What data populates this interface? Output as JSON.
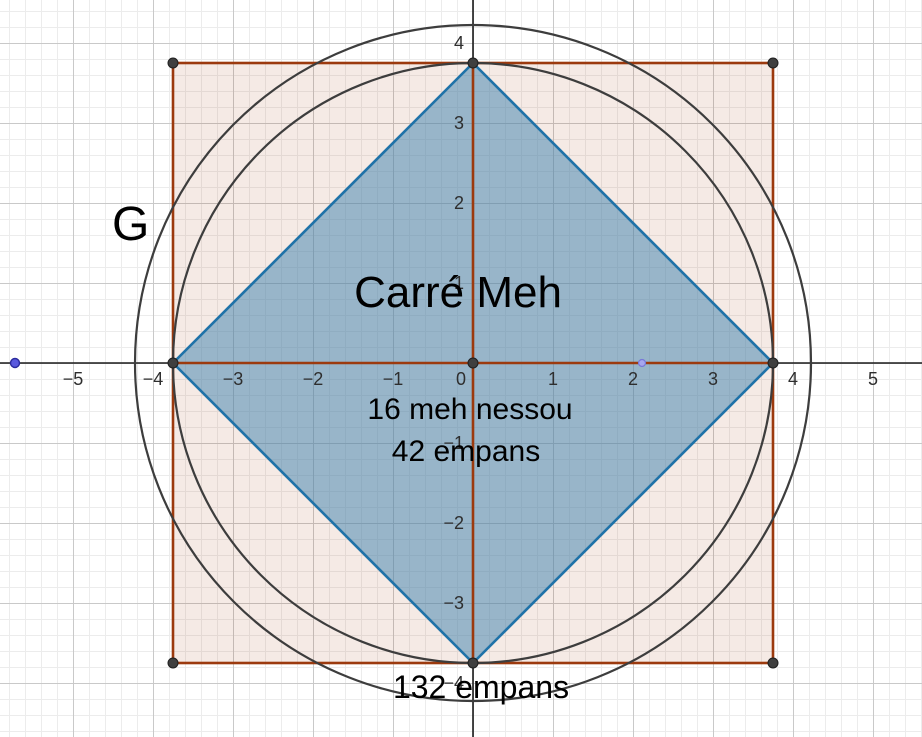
{
  "view": {
    "app": "geometry-graphics-view",
    "width": 922,
    "height": 737
  },
  "labels": {
    "g": "G",
    "title": "Carré Meh",
    "annotation_line1": "16 meh nessou",
    "annotation_line2": "42 empans",
    "annotation_bottom": "132 empans"
  },
  "axes": {
    "unit_px": 80,
    "origin_px": {
      "x": 473,
      "y": 363
    },
    "x_ticks": [
      "−5",
      "−4",
      "−3",
      "−2",
      "−1",
      "0",
      "1",
      "2",
      "3",
      "4",
      "5"
    ],
    "y_ticks": [
      "4",
      "3",
      "2",
      "1",
      "−1",
      "−2",
      "−3",
      "−4"
    ]
  },
  "shapes": {
    "square": {
      "x1": -3.75,
      "y1": -3.75,
      "x2": 3.75,
      "y2": 3.75
    },
    "diamond_vertices": [
      [
        -3.75,
        0
      ],
      [
        0,
        3.75
      ],
      [
        3.75,
        0
      ],
      [
        0,
        -3.75
      ]
    ],
    "inner_circle": {
      "cx": 0,
      "cy": 0,
      "r": 3.75
    },
    "outer_circle": {
      "cx": 0,
      "cy": 0,
      "r": 4.22
    },
    "points_gray": [
      [
        -3.75,
        3.75
      ],
      [
        0,
        3.75
      ],
      [
        3.75,
        3.75
      ],
      [
        -3.75,
        0
      ],
      [
        0,
        0
      ],
      [
        3.75,
        0
      ],
      [
        -3.75,
        -3.75
      ],
      [
        0,
        -3.75
      ],
      [
        3.75,
        -3.75
      ]
    ],
    "point_blue": [
      -5.72,
      0
    ],
    "point_lavender": [
      2.1,
      0
    ]
  },
  "colors": {
    "square_stroke": "#9c3a0e",
    "square_fill": "rgba(153,51,0,0.10)",
    "diamond_stroke": "#1f72a8",
    "diamond_fill": "rgba(70,135,175,0.53)",
    "circle_stroke": "#3d3d3d",
    "axis": "#1c1c1c",
    "grid_major": "#c9c9c9",
    "grid_minor": "#ececec",
    "point_gray": "#3f3f3f",
    "point_blue": "#5a5ade",
    "point_lavender": "#a6a6ef",
    "label_text": "#000000"
  }
}
